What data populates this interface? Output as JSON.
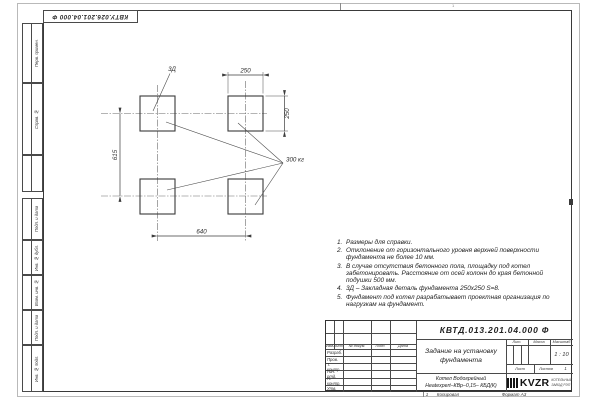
{
  "page": {
    "doc_number_top": "КВТУ.026.201.04.000 Ф",
    "zone_top": "1",
    "copy_number": "1",
    "copied_label": "Копировал",
    "format_label": "Формат А3"
  },
  "margin_strips": [
    "Перв. примен.",
    "Справ. №",
    "Подп. и дата",
    "Инв. № дубл.",
    "Взам. инв. №",
    "Подп. и дата",
    "Инв. № подл."
  ],
  "drawing": {
    "dim_top": "250",
    "dim_right": "250",
    "dim_left": "615",
    "dim_bottom": "640",
    "embed_label": "3Д",
    "load_label": "300 кг"
  },
  "notes": [
    {
      "num": "1.",
      "text": "Размеры для справки."
    },
    {
      "num": "2.",
      "text": "Отклонение от горизонтального уровня верхней поверхности фундамента не более 10 мм."
    },
    {
      "num": "3.",
      "text": "В случае отсутствия бетонного пола, площадку под котел забетонировать. Расстояние от осей колонн до края бетонной подушки 500 мм."
    },
    {
      "num": "4.",
      "text": "3Д – Закладная деталь фундамента 250х250 S=8."
    },
    {
      "num": "5.",
      "text": "Фундамент под котел разрабатывает проектная организация по нагрузкам на фундамент."
    }
  ],
  "title_block": {
    "doc_number": "КВТД.013.201.04.000 Ф",
    "title_line1": "Задание на установку",
    "title_line2": "фундамента",
    "header_cols": [
      "Изм.",
      "Лист",
      "№ докум.",
      "Подп.",
      "Дата"
    ],
    "rows": [
      "Разраб.",
      "Пров.",
      "Т. контр.",
      "Нач. отд.",
      "Н. контр.",
      "Утв."
    ],
    "lit_label": "Лит.",
    "mass_label": "Масса",
    "scale_label": "Масштаб",
    "scale_value": "1 : 10",
    "sheet_label": "Лист",
    "sheets_label": "Листов",
    "sheets_value": "1",
    "product_line1": "Котел Водогрейный",
    "product_line2": "Heatexpert–КВр–0,15– КБД(К)",
    "logo_text": "KVZR",
    "logo_caption_line1": "КОТЕЛЬНЫЙ",
    "logo_caption_line2": "ЗАВОД РЭП"
  }
}
